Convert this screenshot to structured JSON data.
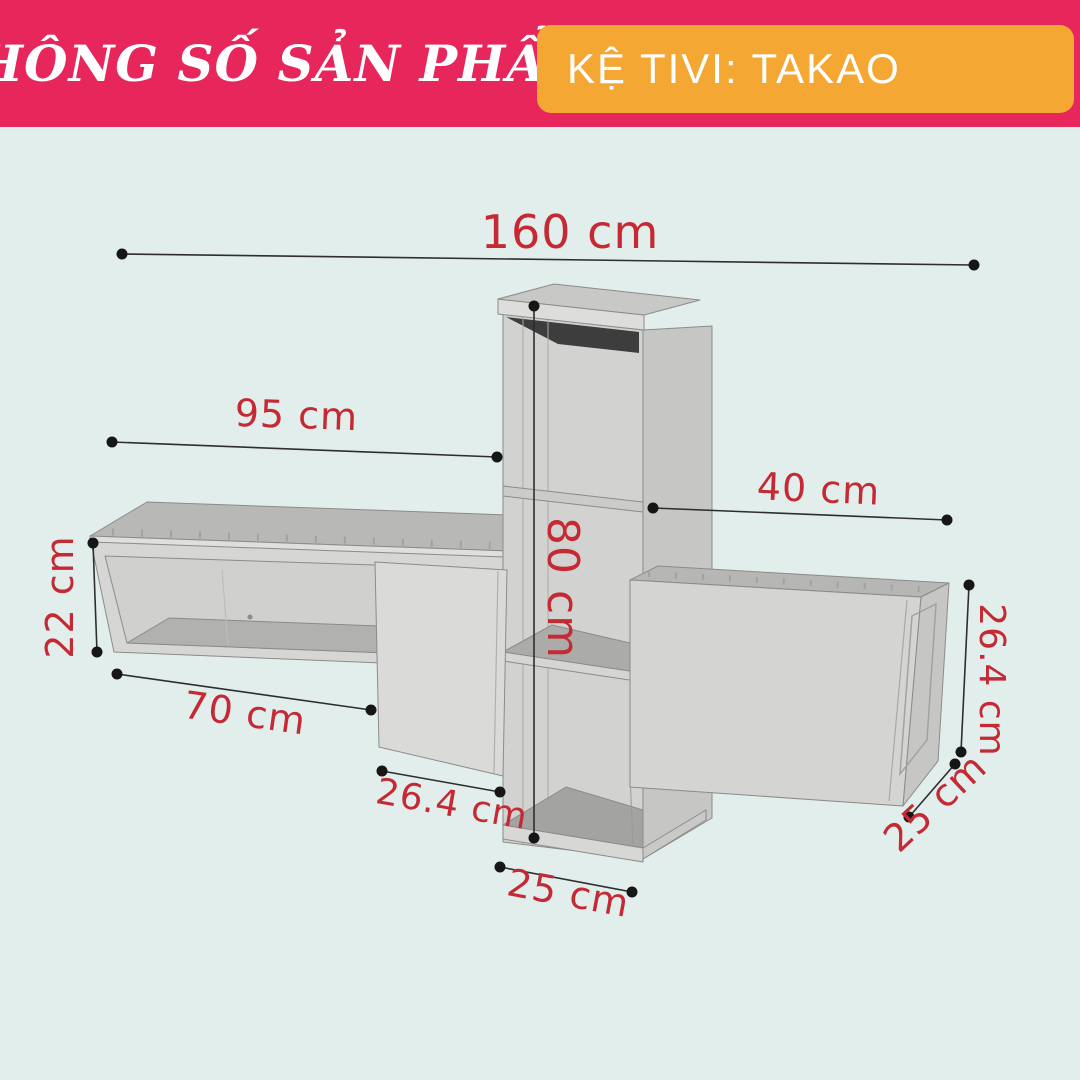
{
  "header": {
    "title": "THÔNG SỐ SẢN PHẨM",
    "product_label": "KỆ TIVI: TAKAO"
  },
  "colors": {
    "header_bg": "#e7265c",
    "tag_bg": "#f5a733",
    "canvas_bg": "#e2eeeb",
    "dim_text": "#c52934",
    "dim_line": "#2e2e2e",
    "dot": "#161616"
  },
  "dimensions": {
    "total_width": {
      "label": "160 cm",
      "value_cm": 160
    },
    "left_shelf_width": {
      "label": "95 cm",
      "value_cm": 95
    },
    "upper_right_width": {
      "label": "40 cm",
      "value_cm": 40
    },
    "left_shelf_height": {
      "label": "22 cm",
      "value_cm": 22
    },
    "column_height": {
      "label": "80 cm",
      "value_cm": 80
    },
    "left_shelf_bottom_width": {
      "label": "70 cm",
      "value_cm": 70
    },
    "door_panel_width": {
      "label": "26.4 cm",
      "value_cm": 26.4
    },
    "column_base_width": {
      "label": "25 cm",
      "value_cm": 25
    },
    "right_cabinet_height": {
      "label": "26.4 cm",
      "value_cm": 26.4
    },
    "right_cabinet_depth": {
      "label": "25 cm",
      "value_cm": 25
    }
  }
}
